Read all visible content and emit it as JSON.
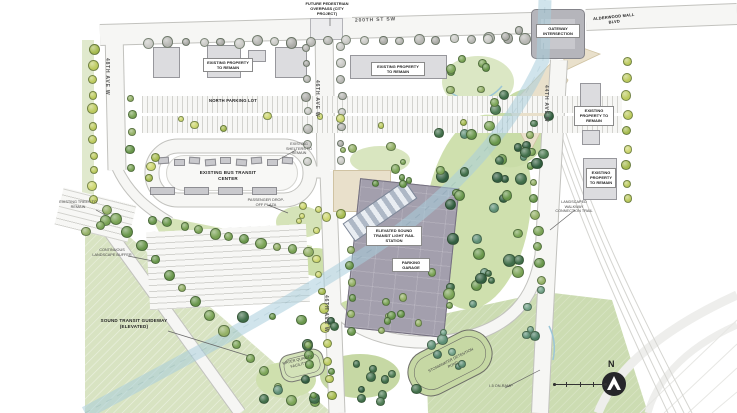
{
  "map": {
    "streets": {
      "s200": "200TH ST SW",
      "a48": "48TH AVE W",
      "a46": "46TH AVE W",
      "a44": "44TH AVE W",
      "alderwood": "ALDERWOOD MALL BLVD"
    },
    "intersection": "GATEWAY INTERSECTION",
    "facilities": {
      "existing_property": "EXISTING PROPERTY TO REMAIN",
      "north_lot": "NORTH PARKING LOT",
      "bus_tc": "EXISTING BUS TRANSIT CENTER",
      "station": "ELEVATED SOUND TRANSIT LIGHT RAIL STATION",
      "garage": "PARKING GARAGE"
    },
    "annotations": {
      "overpass": "FUTURE PEDESTRIAN OVERPASS (CITY PROJECT)",
      "guideway": "SOUND TRANSIT GUIDEWAY (ELEVATED)",
      "trees": "EXISTING TREES TO REMAIN",
      "buffer": "CONTINUOUS LANDSCAPE BUFFER",
      "trail": "LANDSCAPED WALKWAY CONNECTION TRAIL",
      "dropoff": "PASSENGER DROP-OFF PLAZA",
      "shelters": "EXISTING SHELTERS TO REMAIN",
      "wq": "WATER QUALITY FACILITY",
      "pond": "STORMWATER DETENTION POND",
      "ramp": "I-5 ON-RAMP"
    },
    "compass": {
      "north": "N"
    },
    "colors": {
      "guideway_blue": "#aacfdd",
      "field_green": "#d8e3c2",
      "garage_gray": "#a39fad",
      "road_fill": "#f6f6f4"
    }
  }
}
